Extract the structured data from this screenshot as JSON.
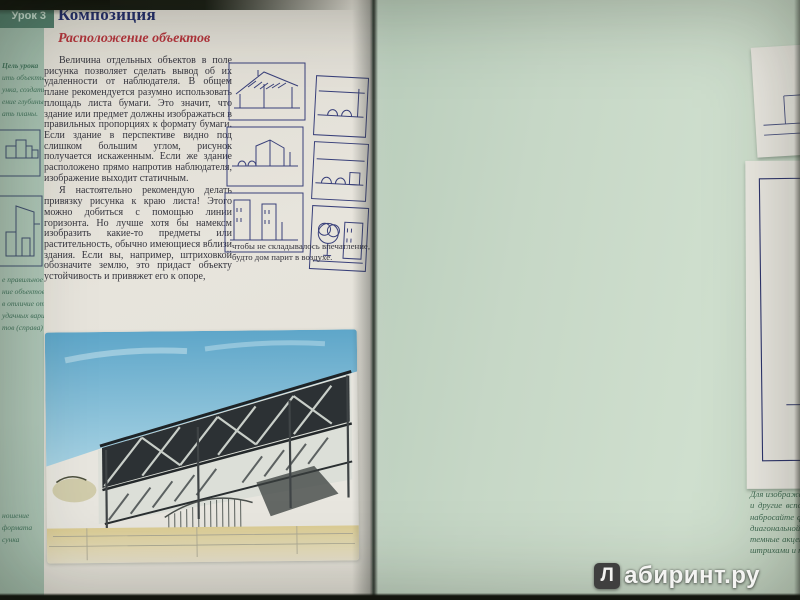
{
  "left_page": {
    "tab_label": "Урок 3",
    "title": "Композиция",
    "subtitle": "Расположение объектов",
    "sidebar": {
      "goal_heading": "Цель урока",
      "goal_lines": [
        "ить объекты",
        "унка, создать",
        "ение глубины,",
        "ать планы."
      ],
      "figure_caption_lines": [
        "е правильное",
        "ние объектов",
        "в отличие от",
        "удачных вари-",
        "тов (справа)"
      ],
      "bottom_caption_lines": [
        "ношение",
        "формата",
        "сунка"
      ]
    },
    "paragraphs": {
      "p1": "Величина отдельных объектов в поле рисунка позволяет сделать вывод об их удаленности от наблюдателя. В общем плане рекомендуется разумно использовать площадь листа бумаги. Это значит, что здание или предмет должны изображаться в правильных пропорциях к формату бумаги. Если здание в перспективе видно под слишком большим углом, рисунок получается искаженным. Если же здание расположено прямо напротив наблюдателя, изображение выходит статичным.",
      "p2": "Я настоятельно рекомендую делать привязку рисунка к краю листа! Этого можно добиться с помощью линии горизонта. Но лучше хотя бы намеком изобразить какие-то предметы или растительность, обычно имеющиеся вблизи здания. Если вы, например, штриховкой обозначите землю, это придаст объекту устойчивость и привяжет его к опоре,",
      "continuation": "чтобы не складывалось впечатление, будто дом парит в воздухе."
    }
  },
  "right_page": {
    "caption": "Для изображения ряда домов на набережной выберите горизонтальный формат, проведите линию горизонта и другие вспомогательные линии. Затем сделайте вертикальную разметку отдельных строений и начерно набросайте форму крыши. После прорисовки всех окон и других деталей фасадов нанесите тени с помощью диагональной штриховки. Штрихи могут местами выходить за границы зданий. В заключение расставьте темные акценты под козырьками крыш и пролетами моста. Люди на набережной, обозначенные короткими штрихами и точками, оживляют рисунок и подчеркивают масштаб зданий.",
    "page_number": "39"
  },
  "watermark": {
    "logo_letter": "Л",
    "text": "абиринт.ру"
  },
  "colors": {
    "title_navy": "#232e6b",
    "subtitle_red": "#b5353c",
    "ink_blue": "#2e356d",
    "sidebar_green": "#a6c0b0",
    "right_page_green": "#c6d7c6"
  }
}
